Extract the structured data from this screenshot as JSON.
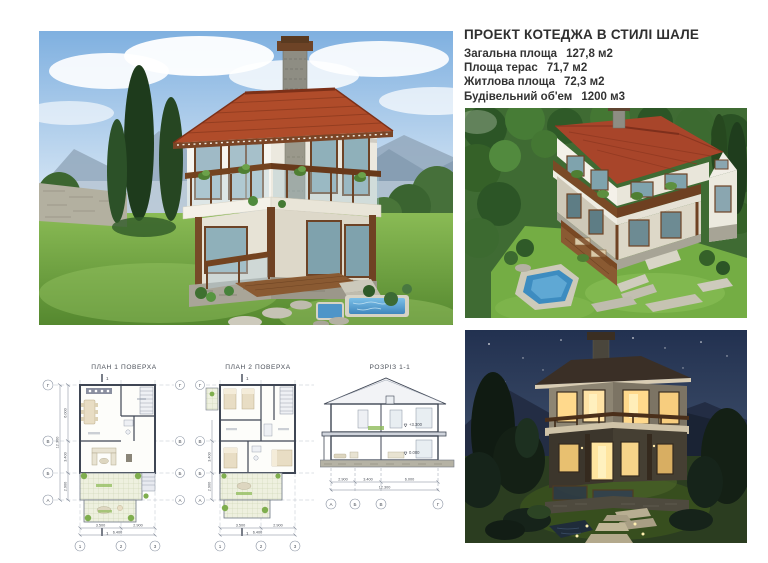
{
  "header": {
    "title": "ПРОЕКТ КОТЕДЖА В СТИЛІ ШАЛЕ",
    "specs": [
      {
        "label": "Загальна площа",
        "value": "127,8 м2"
      },
      {
        "label": "Площа терас",
        "value": "71,7 м2"
      },
      {
        "label": "Житлова площа",
        "value": "72,3 м2"
      },
      {
        "label": "Будівельний об'ем",
        "value": "1200 м3"
      }
    ]
  },
  "renders": {
    "main": "day-front-exterior-render",
    "aerial": "day-aerial-exterior-render",
    "night": "night-exterior-render"
  },
  "drawings": {
    "plan1": {
      "label": "ПЛАН 1 ПОВЕРХА",
      "row_axes": [
        "Г",
        "В",
        "Б",
        "А"
      ],
      "col_axes": [
        "1",
        "2",
        "3"
      ],
      "section_mark": "1",
      "dims_bottom": [
        "3.500",
        "2.900"
      ],
      "dims_bottom_total": "6.400",
      "dims_left": [
        "6.000",
        "3.400",
        "2.900"
      ],
      "dims_left_total": "12.300"
    },
    "plan2": {
      "label": "ПЛАН 2 ПОВЕРХА",
      "row_axes": [
        "Г",
        "В",
        "Б",
        "А"
      ],
      "col_axes": [
        "1",
        "2",
        "3"
      ],
      "section_mark": "1",
      "dims_bottom": [
        "3.500",
        "2.900"
      ],
      "dims_bottom_total": "6.400",
      "dims_left": [
        "6.000",
        "3.400",
        "2.900"
      ],
      "dims_left_total": "12.300"
    },
    "section": {
      "label": "РОЗРІЗ 1-1",
      "axes": [
        "А",
        "Б",
        "В",
        "Г"
      ],
      "dims": [
        "2.900",
        "3.400",
        "6.000"
      ],
      "dim_total": "12.300",
      "elevation_upper": "+3.300",
      "elevation_lower": "0.000"
    }
  },
  "colors": {
    "roof_red": "#a8452a",
    "wood_brown": "#6d4326",
    "stone_gray": "#9a988b",
    "grass_green": "#74ad44",
    "sky_blue": "#8fb8e4",
    "night_sky": "#273750",
    "pool_blue": "#4e95c8",
    "text": "#333333"
  }
}
